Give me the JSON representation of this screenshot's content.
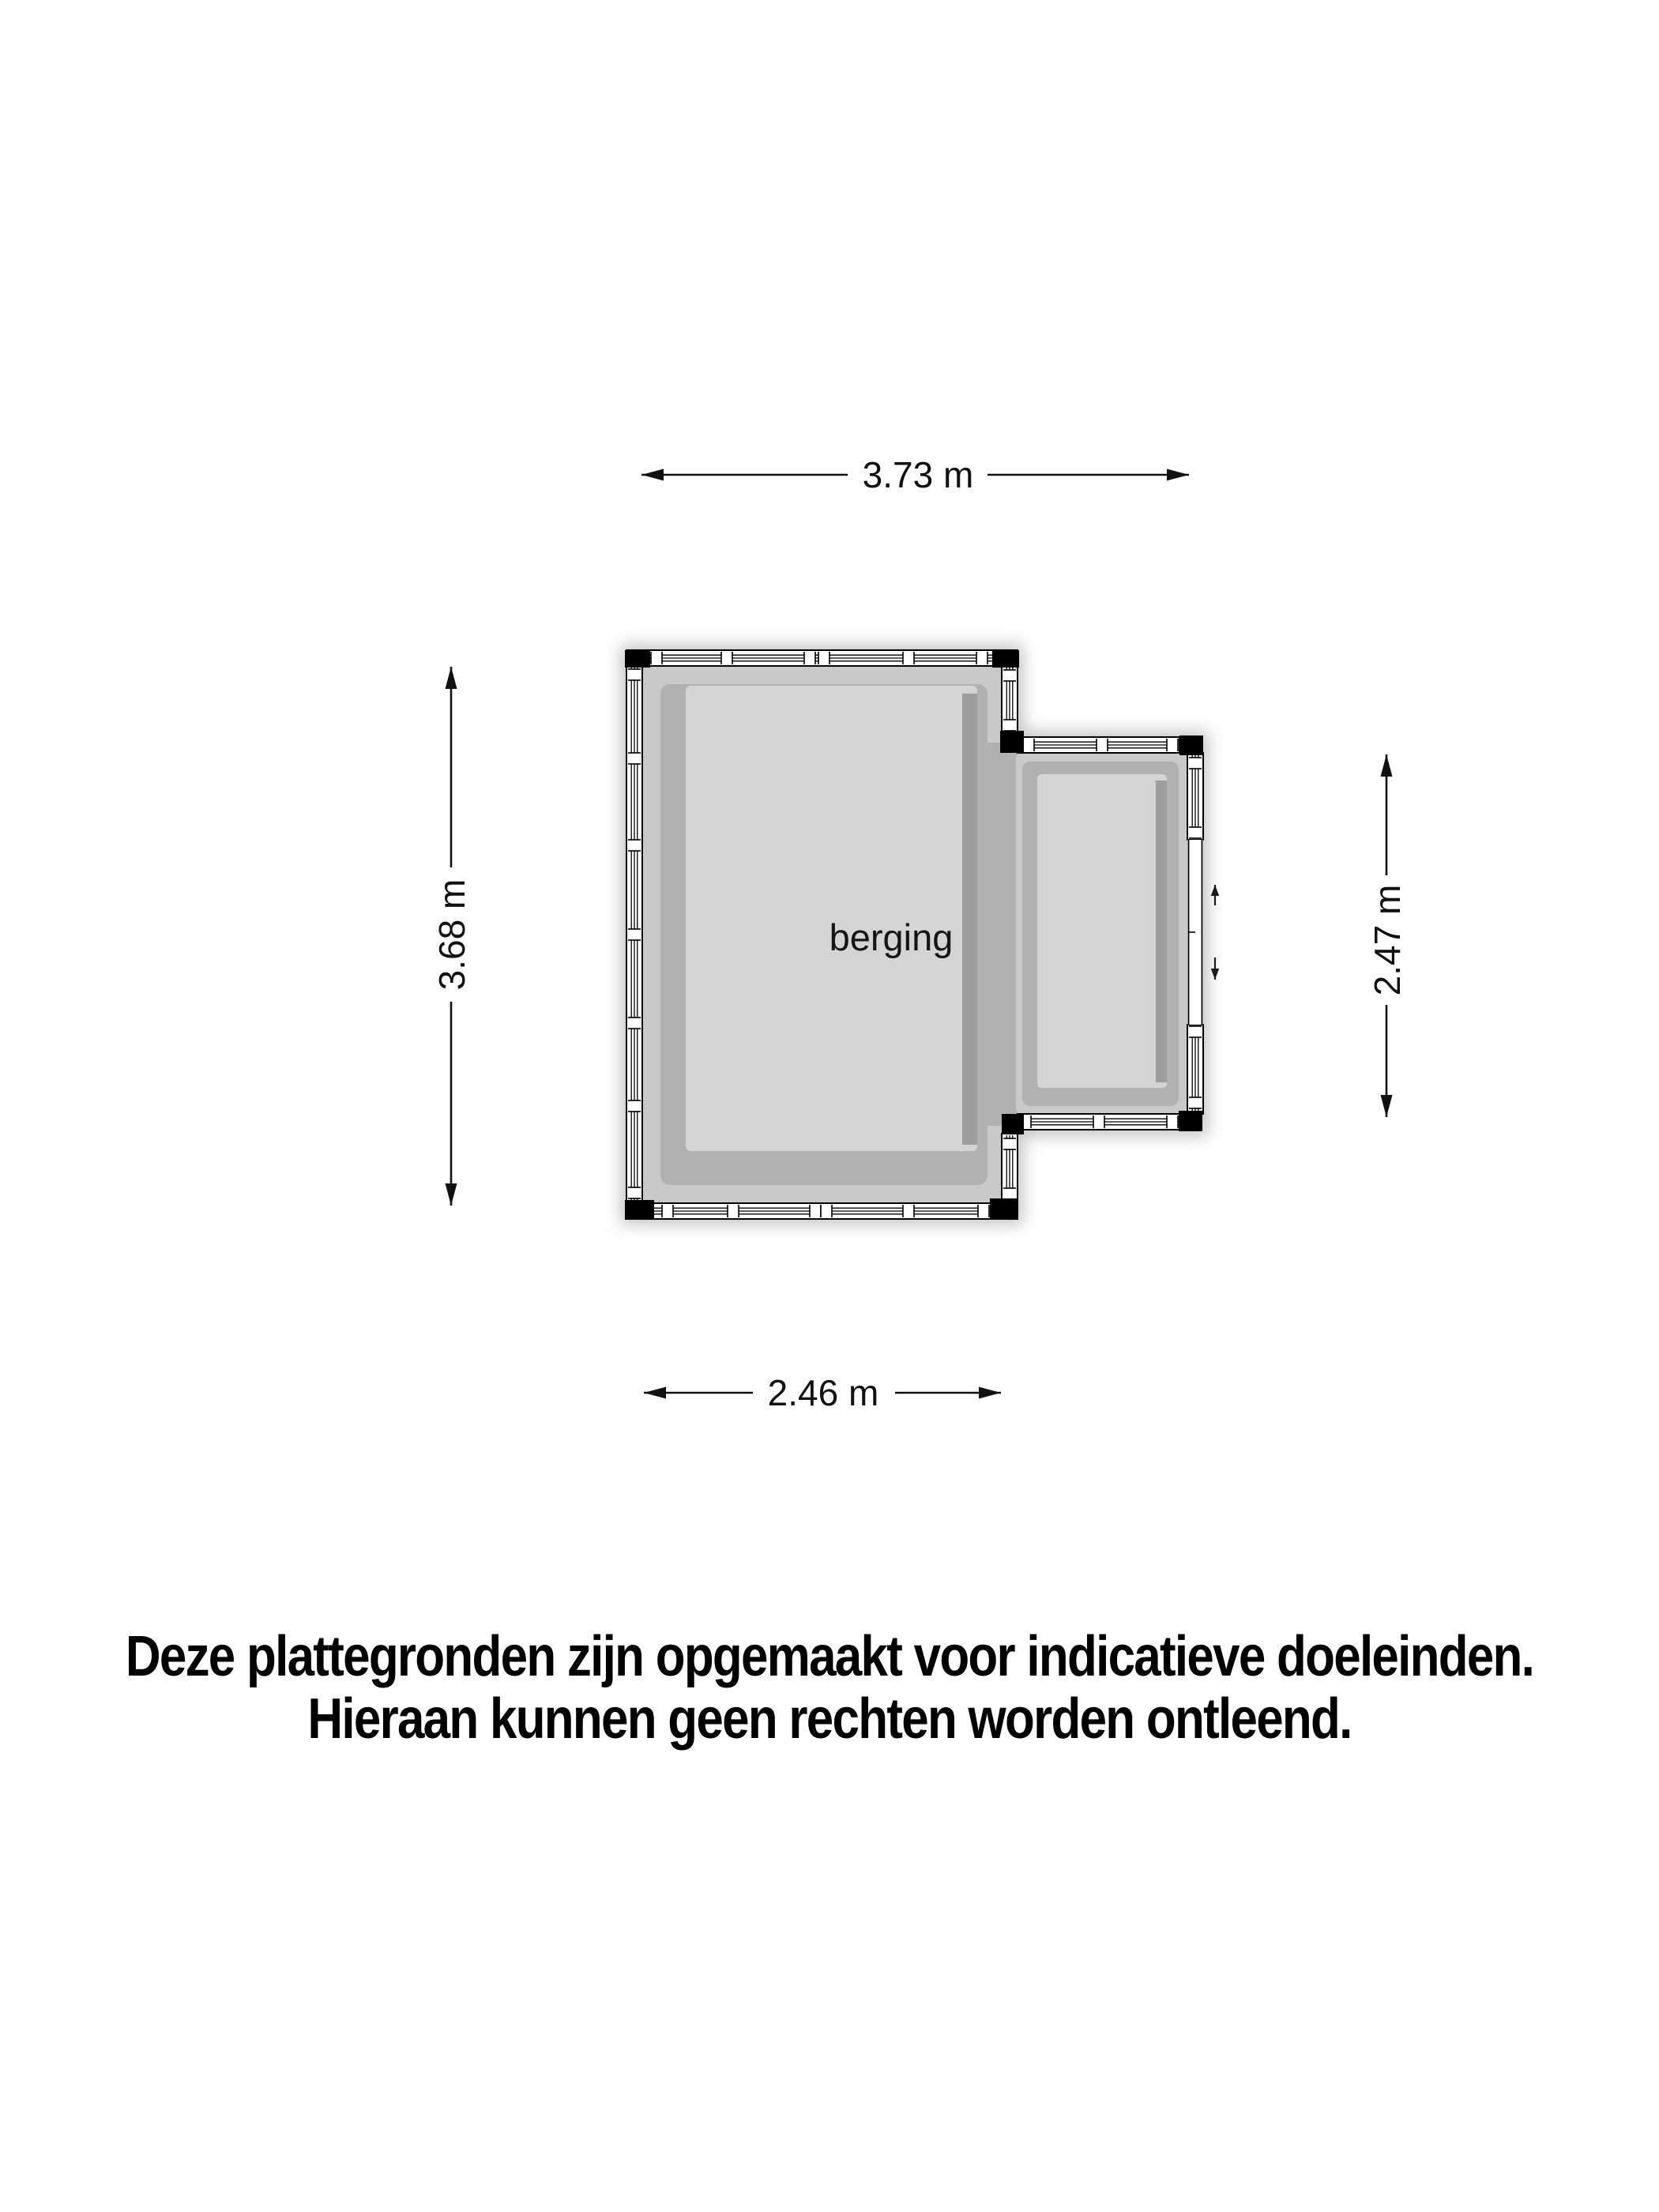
{
  "floor_plan": {
    "room_label": "berging",
    "dimensions": {
      "top": "3.73 m",
      "left": "3.68 m",
      "right": "2.47 m",
      "bottom": "2.46 m"
    },
    "door_arrows": [
      "up",
      "down"
    ]
  },
  "disclaimer": {
    "line1": "Deze plattegronden zijn opgemaakt voor indicatieve doeleinden.",
    "line2": "Hieraan kunnen geen rechten worden ontleend."
  },
  "colors": {
    "background": "#ffffff",
    "floor": "#d4d4d4",
    "wall_light": "#c9c9c9",
    "wall_mid": "#b1b1b1",
    "wall_shadow_strip": "#9e9e9e",
    "glazing_outline": "#000000",
    "dimension_color": "#111111"
  }
}
